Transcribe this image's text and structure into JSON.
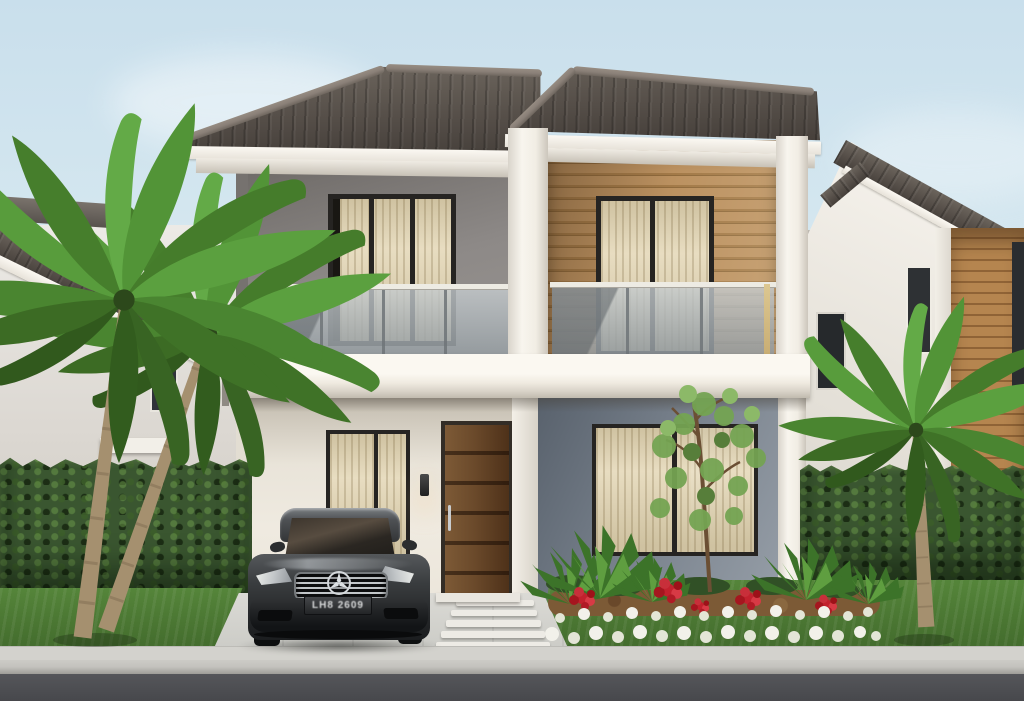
{
  "scene": {
    "description": "3D exterior render of a modern two-story house with glass balcony, wood-slat accent wall, front garden, palm trees and a dark sedan parked in the driveway",
    "setting": "residential street, daytime"
  },
  "car": {
    "type": "sedan",
    "emblem": "mercedes-three-pointed-star",
    "license_plate": "LH8 2609"
  },
  "palette": {
    "sky_top": "#c9dfec",
    "sky_low": "#edf4f3",
    "roof_tile": "#564f49",
    "roof_tile_light": "#6b645c",
    "roof_ridge": "#8a8078",
    "wall_upper": "#8d8987",
    "wood": "#b28a56",
    "white_trim": "#f5f2ea",
    "wall_porch": "#efeae0",
    "wall_slate": "#78818c",
    "frame": "#262422",
    "curtain": "#e8ddc1",
    "curtain_dark": "#cfc2a1",
    "door": "#6b4a2b",
    "hedge": "#3a5630",
    "lawn": "#55853a",
    "lawn_dark": "#436c2d",
    "palm_green": "#4f8d33",
    "palm_trunk": "#a5906f",
    "drive": "#dbdad5",
    "curb": "#c3c2bd",
    "road": "#55565a",
    "mulch": "#7c5a36",
    "flower_red": "#c2202c",
    "flower_white": "#f1f0e8",
    "car_body": "#333537",
    "chrome": "#c3c7ca",
    "plate_text": "#d9dadb",
    "brass": "#c9ae74"
  }
}
